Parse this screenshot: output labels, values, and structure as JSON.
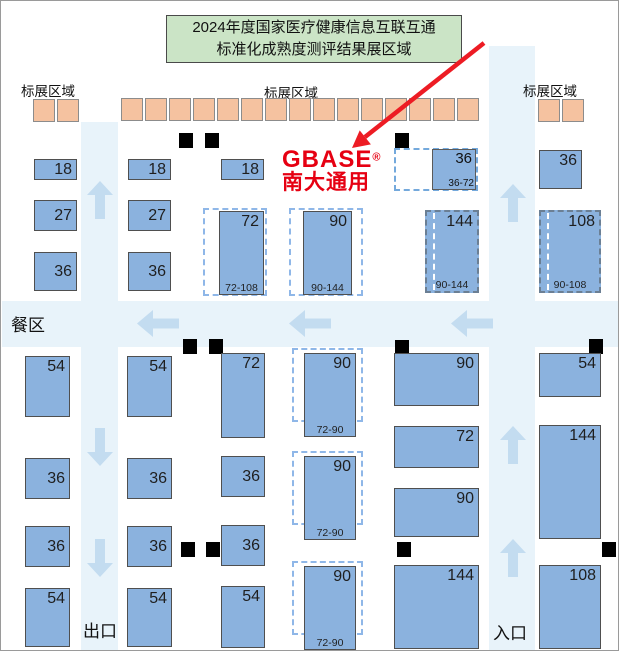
{
  "title": {
    "line1": "2024年度国家医疗健康信息互联互通",
    "line2": "标准化成熟度测评结果展区域"
  },
  "labels": {
    "standard_booth_area": "标展区域",
    "dining_area": "餐区",
    "exit": "出口",
    "entrance": "入口"
  },
  "logo": {
    "brand": "GBASE",
    "registered": "®",
    "company_cn": "南大通用"
  },
  "colors": {
    "booth_blue": "#8BB2DE",
    "aisle_blue": "#E8F3FA",
    "arrow_blue": "#C3DCF0",
    "standard_booth_orange": "#F5C2A0",
    "title_green": "#CBE4C6",
    "brand_red": "#E60012",
    "dashed_blue": "#8FB7E8",
    "marker_black": "#000000"
  },
  "booths": {
    "a1": {
      "num": "18"
    },
    "a2": {
      "num": "27"
    },
    "a3": {
      "num": "36"
    },
    "b1": {
      "num": "18"
    },
    "b2": {
      "num": "27"
    },
    "b3": {
      "num": "36"
    },
    "c1": {
      "num": "18"
    },
    "c2": {
      "num": "72",
      "range": "72-108"
    },
    "d2": {
      "num": "90",
      "range": "90-144"
    },
    "e1": {
      "num": "36",
      "range": "36-72"
    },
    "e2": {
      "num": "144",
      "range": "90-144"
    },
    "f1": {
      "num": "36"
    },
    "f2": {
      "num": "108",
      "range": "90-108"
    },
    "a4": {
      "num": "54"
    },
    "a5": {
      "num": "36"
    },
    "a6": {
      "num": "36"
    },
    "a7": {
      "num": "54"
    },
    "b4": {
      "num": "54"
    },
    "b5": {
      "num": "36"
    },
    "b6": {
      "num": "36"
    },
    "b7": {
      "num": "54"
    },
    "c4": {
      "num": "72"
    },
    "c5": {
      "num": "36"
    },
    "c6": {
      "num": "36"
    },
    "c7": {
      "num": "54"
    },
    "d4": {
      "num": "90",
      "range": "72-90"
    },
    "d5": {
      "num": "90",
      "range": "72-90"
    },
    "d7": {
      "num": "90",
      "range": "72-90"
    },
    "e4": {
      "num": "90"
    },
    "e5": {
      "num": "72"
    },
    "e6": {
      "num": "90"
    },
    "e7": {
      "num": "144"
    },
    "f4": {
      "num": "54"
    },
    "f5": {
      "num": "144"
    },
    "f7": {
      "num": "108"
    }
  }
}
